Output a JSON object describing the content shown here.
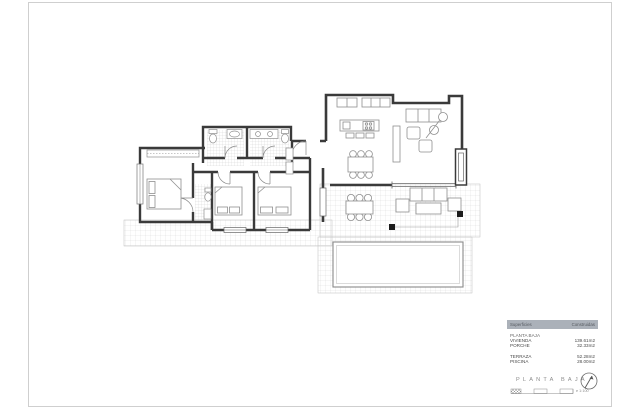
{
  "legend": {
    "col_area": "Superficies",
    "col_built": "Construidas",
    "group": "PLANTA BAJA",
    "rows": [
      {
        "label": "VIVIENDA",
        "value": "139.61m2"
      },
      {
        "label": "PORCHE",
        "value": "32.33m2"
      },
      {
        "label": "TERRAZA",
        "value": "52.28m2"
      },
      {
        "label": "PISCINA",
        "value": "28.00m2"
      }
    ]
  },
  "titleblock": {
    "title": "PLANTA BAJA",
    "scale_label": "e 1:100"
  },
  "colors": {
    "wall": "#3a3a3a",
    "furniture": "#8f8f8f",
    "tile_line": "#d9d9d9",
    "legend_header_bg": "#abb1b9",
    "sheet_border": "#cfcfcf"
  }
}
